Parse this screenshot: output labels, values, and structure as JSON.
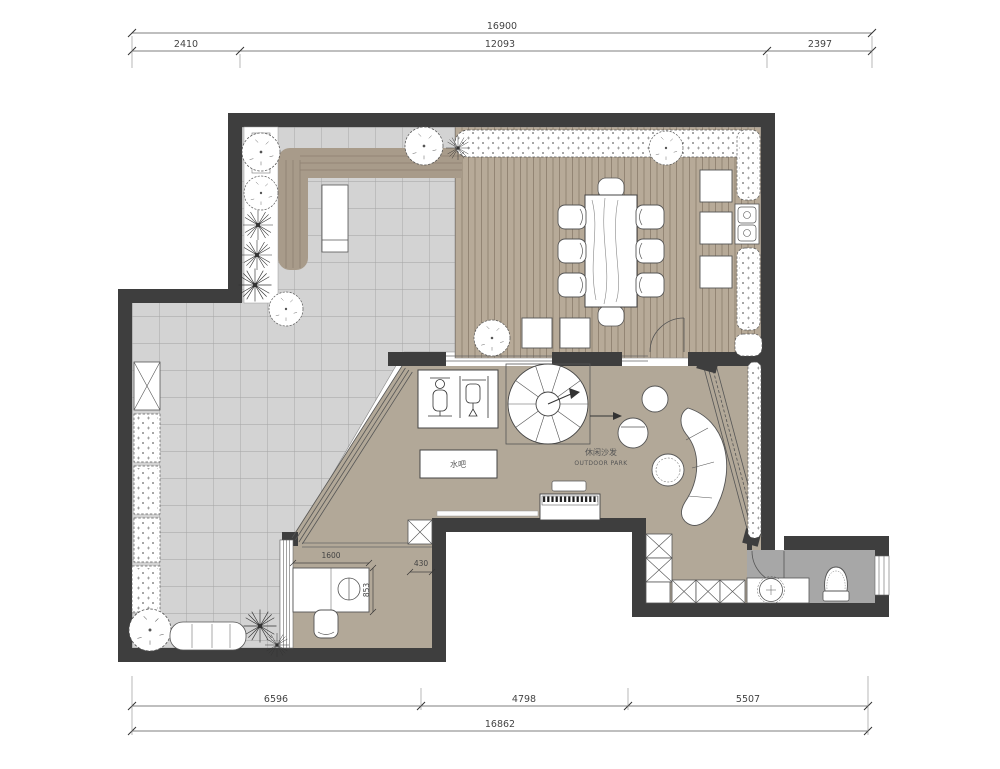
{
  "plan": {
    "kind": "terrace floor plan drawing",
    "labels": {
      "lounge_cn": "休闲沙发",
      "lounge_en": "OUTDOOR PARK",
      "water_bar": "水吧"
    },
    "dimensions": {
      "top": {
        "total": "16900",
        "segments": [
          "2410",
          "12093",
          "2397"
        ]
      },
      "bottom": {
        "total": "16862",
        "segments": [
          "6596",
          "4798",
          "5507"
        ]
      },
      "interior": {
        "desk_width": "1600",
        "cabinet_depth": "430",
        "desk_depth": "853"
      }
    },
    "colors": {
      "wall": "#3e3e3e",
      "tile_floor": "#d3d3d3",
      "wood_deck": "#b7aa98",
      "interior_floor": "#b2a898",
      "bath_floor": "#a7a7a7",
      "dim_text": "#444444"
    }
  }
}
